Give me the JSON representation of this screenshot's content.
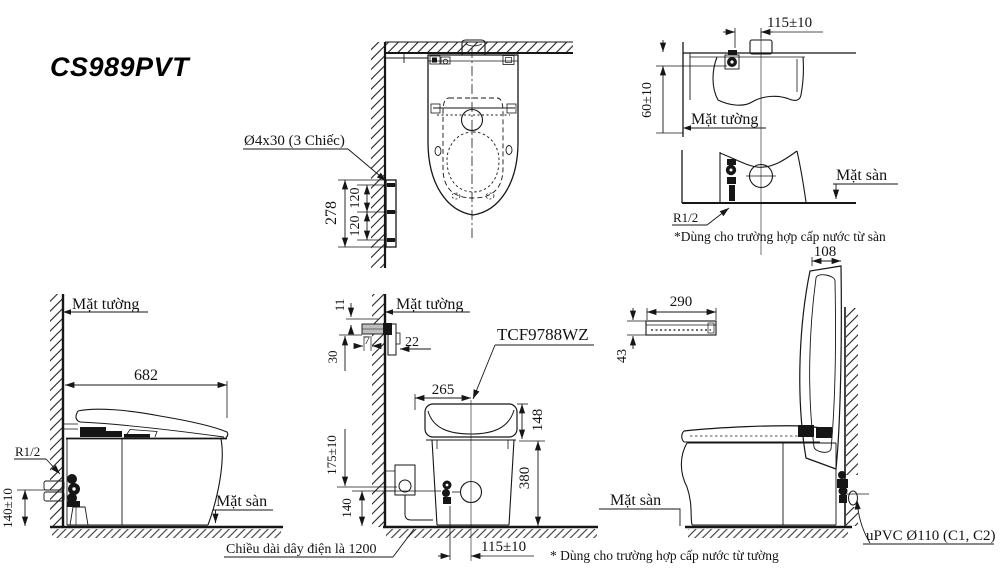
{
  "title": "CS989PVT",
  "top_view": {
    "screw_label": "Ø4x30 (3 Chiếc)",
    "dim_total": "278",
    "dim_upper": "120",
    "dim_lower": "120"
  },
  "wall_supply_view": {
    "dim_offset": "115±10",
    "dim_height": "60±10",
    "wall_label": "Mặt tường"
  },
  "floor_supply_view": {
    "floor_label": "Mặt sàn",
    "thread_label": "R1/2",
    "note": "*Dùng cho trường hợp cấp nước từ sàn"
  },
  "side_view": {
    "wall_label": "Mặt tường",
    "dim_depth": "682",
    "thread_label": "R1/2",
    "dim_inlet_height": "140±10",
    "floor_label": "Mặt sàn"
  },
  "rear_view": {
    "wall_label": "Mặt tường",
    "dim_bracket_gap": "11",
    "dim_bracket_width": "7",
    "dim_bracket_offset": "22",
    "dim_bracket_height": "30",
    "unit_label": "TCF9788WZ",
    "dim_center_offset": "265",
    "dim_unit_height": "148",
    "dim_body_height": "380",
    "dim_supply_height": "175±10",
    "dim_valve_height": "140",
    "dim_valve_offset": "115±10",
    "cord_note": "Chiều dài dây điện là 1200",
    "wall_supply_note": "* Dùng cho trường hợp cấp nước từ tường"
  },
  "open_lid_view": {
    "dim_lid_width": "108",
    "dim_remote_width": "290",
    "dim_remote_height": "43",
    "floor_label": "Mặt sàn",
    "pipe_label": "uPVC Ø110 (C1, C2)"
  }
}
